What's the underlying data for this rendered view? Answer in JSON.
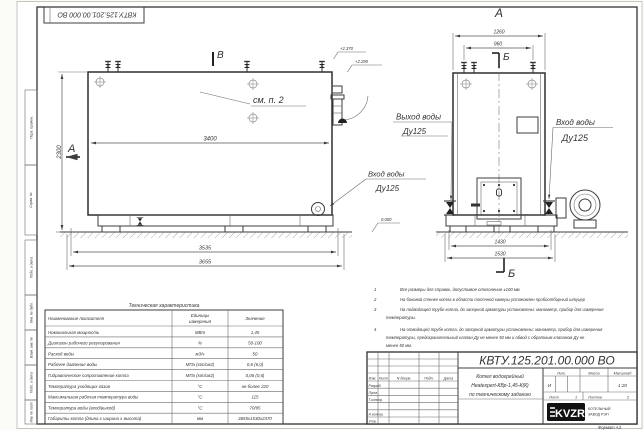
{
  "sheet": {
    "stamp": "КВТУ.125.201.00.000  ВО",
    "format_note": "Формат  А3",
    "margin_labels": [
      "Перв. примен.",
      "Справ. №",
      "Подп. и дата",
      "Инв. № дубл.",
      "Взам. инв. №",
      "Подп. и дата",
      "Инв. № подл."
    ]
  },
  "front_view": {
    "marker_top": "В",
    "marker_left": "А",
    "see_note": "см. п. 2",
    "dim_width": "3400",
    "dim_height": "2300",
    "dim_base_inner": "3535",
    "dim_base_outer": "3655",
    "elev_top": "+2.370",
    "elev_mid": "+2.290",
    "elev_zero": "0.000",
    "inlet_label": "Вход воды",
    "inlet_dn": "Ду125"
  },
  "side_view": {
    "title": "А",
    "dim_top_outer": "1260",
    "dim_top_inner": "960",
    "marker_top": "Б",
    "marker_bottom": "Б",
    "dim_base_inner": "1430",
    "dim_base_outer": "1530",
    "outlet_label": "Выход воды",
    "outlet_dn": "Ду125",
    "inlet_label": "Вход воды",
    "inlet_dn": "Ду125"
  },
  "notes": {
    "items": [
      {
        "num": "1",
        "lines": [
          "Все размеры для справок, допустимое отклонение  ±100 мм."
        ]
      },
      {
        "num": "2",
        "lines": [
          "На боковой стенке котла в области топочной камеры установлен пробоотборный штуцер"
        ]
      },
      {
        "num": "3",
        "lines": [
          "На  подводящей трубе котла, до запорной арматуры установлены: манометр, прибор для измерения",
          "температуры."
        ]
      },
      {
        "num": "4",
        "lines": [
          "На отводящей трубе котла, до запорной арматуры установлены: манометр, прибор для измерения",
          "температуры, предохранительный клапан  Ду не менее 50 мм и обвод с обратным клапаном  Ду не",
          "менее  50 мм."
        ]
      }
    ]
  },
  "tech_table": {
    "title": "Техническая характеристика",
    "col_name": "Наименование показателя",
    "col_unit_1": "Единицы",
    "col_unit_2": "измерения",
    "col_value": "Значение",
    "rows": [
      {
        "name": "Номинальная мощность",
        "unit": "МВт",
        "value": "1,45"
      },
      {
        "name": "Диапазон рабочего регулирования",
        "unit": "%",
        "value": "50-100"
      },
      {
        "name": "Расход воды",
        "unit": "м3/ч",
        "value": "50"
      },
      {
        "name": "Рабочее давление воды",
        "unit": "МПа (кгс/см2)",
        "value": "0,6 (6,0)"
      },
      {
        "name": "Гидравлическое сопротивление котла",
        "unit": "МПа (кгс/см2)",
        "value": "0,06 (0,6)"
      },
      {
        "name": "Температура уходящих газов",
        "unit": "°С",
        "value": "не более 220"
      },
      {
        "name": "Максимальная рабочая температура воды",
        "unit": "°С",
        "value": "115"
      },
      {
        "name": "Температура воды (вход/выход)",
        "unit": "°С",
        "value": "70/95"
      },
      {
        "name": "Габариты котла (длина х ширина х высота)",
        "unit": "мм",
        "value": "3655х1530х2370"
      }
    ]
  },
  "title_block": {
    "designation": "КВТУ.125.201.00.000  ВО",
    "doc_line1": "Котел водогрейный",
    "doc_line2": "Heatexpert-КВр-1,45-К(К)",
    "doc_line3": "по техническому заданию",
    "col_izm": "Изм.",
    "col_list": "Лист",
    "col_docum": "N докум.",
    "col_podp": "Подп.",
    "col_data": "Дата",
    "row_razrab": "Разраб.",
    "row_prov": "Пров.",
    "row_tkontr": "Т.контр.",
    "row_nkontr": "Н.контр.",
    "row_utv": "Утв.",
    "lit_header": "Лит.",
    "lit_value": "И",
    "mass_header": "Масса",
    "scale_header": "Масштаб",
    "scale_value": "1:20",
    "sheet_label": "Лист",
    "sheet_value": "1",
    "sheets_label": "Листов",
    "sheets_value": "2",
    "logo_text": "KVZR",
    "company_line1": "КОТЕЛЬНЫЙ",
    "company_line2": "ЗАВОД РЭП"
  }
}
